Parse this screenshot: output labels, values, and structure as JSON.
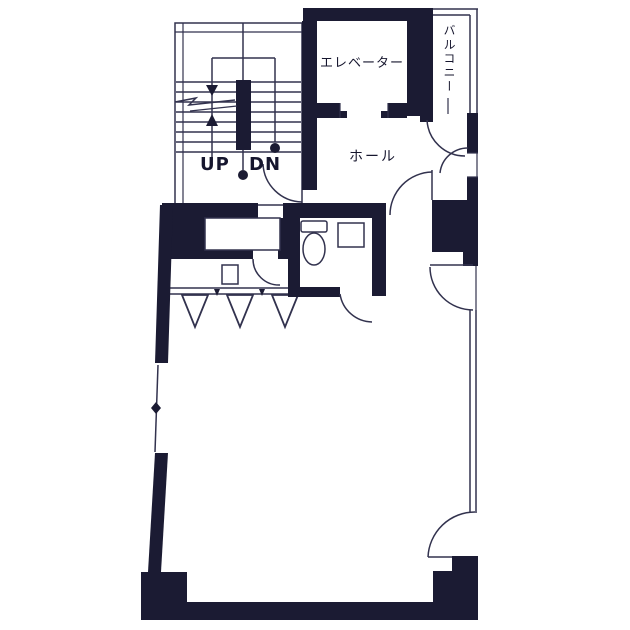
{
  "plan": {
    "labels": {
      "elevator": "エレベーター",
      "balcony": "バルコニー",
      "hall": "ホール",
      "stairs_up": "UP",
      "stairs_down": "DN"
    }
  },
  "colors": {
    "wall": "#1b1b33",
    "line": "#32324e",
    "text": "#16162e",
    "bg": "#ffffff"
  }
}
